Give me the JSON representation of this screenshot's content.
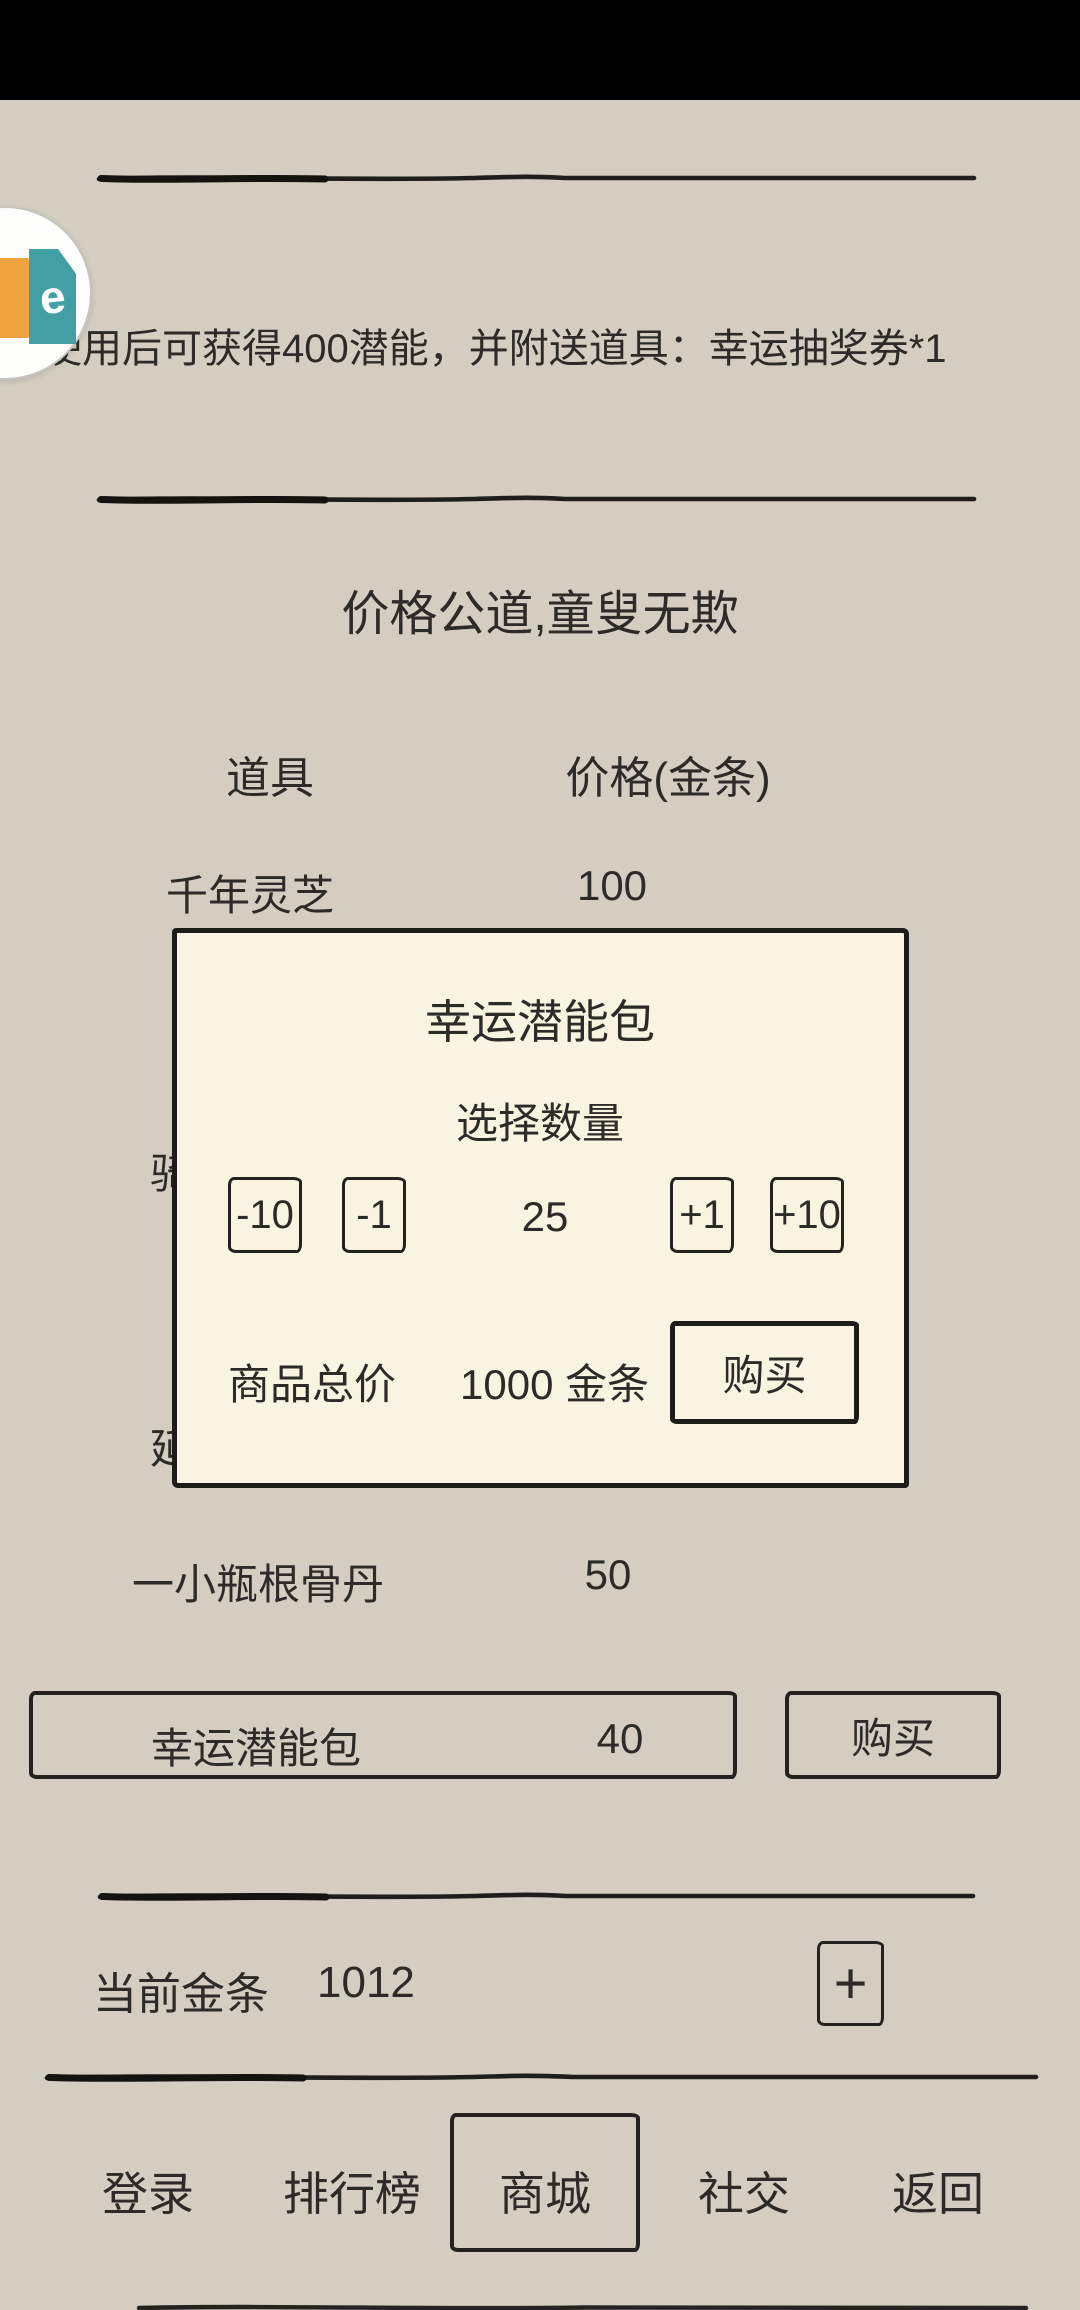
{
  "page": {
    "bg_color": "#d3cec1",
    "ink_color": "#23221e",
    "dialog_bg": "#f9f3e2"
  },
  "float_icon": {
    "glyph": "e",
    "orange": "#efa23e",
    "teal": "#42a0a4"
  },
  "item_detail": {
    "description": "使用后可获得400潜能，并附送道具：幸运抽奖券*1"
  },
  "shop": {
    "motto": "价格公道,童叟无欺",
    "columns": {
      "item": "道具",
      "price": "价格(金条)"
    },
    "rows": [
      {
        "name": "千年灵芝",
        "price": "100"
      },
      {
        "name": "骑",
        "price": ""
      },
      {
        "name": "延",
        "price": ""
      },
      {
        "name": "一小瓶根骨丹",
        "price": "50"
      },
      {
        "name": "幸运潜能包",
        "price": "40"
      }
    ],
    "buy_label": "购买"
  },
  "dialog": {
    "title": "幸运潜能包",
    "subtitle": "选择数量",
    "stepper": {
      "dec10": "-10",
      "dec1": "-1",
      "value": "25",
      "inc1": "+1",
      "inc10": "+10"
    },
    "total_label": "商品总价",
    "total_value": "1000 金条",
    "buy_label": "购买"
  },
  "wallet": {
    "label": "当前金条",
    "value": "1012",
    "add_label": "+"
  },
  "nav": {
    "items": [
      {
        "label": "登录"
      },
      {
        "label": "排行榜"
      },
      {
        "label": "商城"
      },
      {
        "label": "社交"
      },
      {
        "label": "返回"
      }
    ]
  }
}
